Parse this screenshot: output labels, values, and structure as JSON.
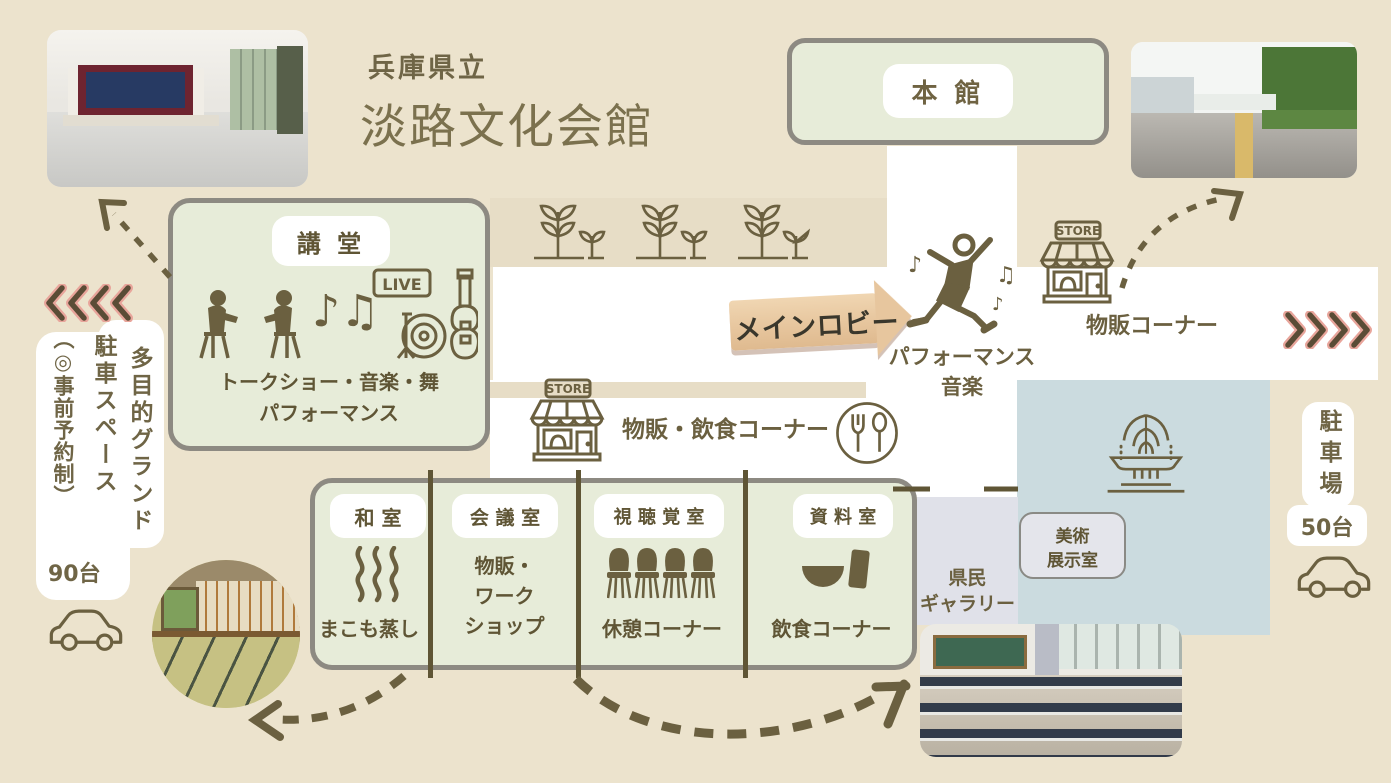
{
  "title": {
    "prefecture": "兵庫県立",
    "name": "淡路文化会館"
  },
  "main_building": {
    "label": "本 館"
  },
  "auditorium": {
    "label": "講 堂",
    "desc1": "トークショー・音楽・舞",
    "desc2": "パフォーマンス",
    "notes_glyph": "♪♫",
    "live_sign": "LIVE"
  },
  "lobby": {
    "arrow": "メインロビー",
    "act1": "パフォーマンス",
    "act2": "音楽",
    "note1": "♪",
    "note2": "♫",
    "note3": "♪"
  },
  "store_top": {
    "sign": "STORE",
    "label": "物販コーナー"
  },
  "store_mid": {
    "sign": "STORE",
    "label": "物販・飲食コーナー"
  },
  "rooms": [
    {
      "name": "和 室",
      "desc": "まこも蒸し"
    },
    {
      "name": "会 議 室",
      "desc1": "物販・",
      "desc2": "ワーク",
      "desc3": "ショップ"
    },
    {
      "name": "視 聴 覚 室",
      "desc": "休憩コーナー"
    },
    {
      "name": "資 料 室",
      "desc": "飲食コーナー"
    }
  ],
  "gallery": {
    "line1": "県民",
    "line2": "ギャラリー"
  },
  "art_room": {
    "line1": "美術",
    "line2": "展示室"
  },
  "parking_left": {
    "col1": "多目的グランド",
    "col2": "駐車スペース",
    "col3": "（◎事前予約制）",
    "capacity": "90台"
  },
  "parking_right": {
    "label": "駐車場",
    "capacity": "50台"
  },
  "colors": {
    "background": "#ece3cd",
    "accent_olive": "#6b6040",
    "box_green": "#e7ecd9",
    "border_gray": "#8d8a82",
    "blue_area": "#cbdbdf",
    "lavender_area": "#e0e1e9",
    "chevron_brown": "#5a4c36",
    "chevron_pink": "#e8a59b",
    "arrow_wood": "#e9cba6"
  }
}
